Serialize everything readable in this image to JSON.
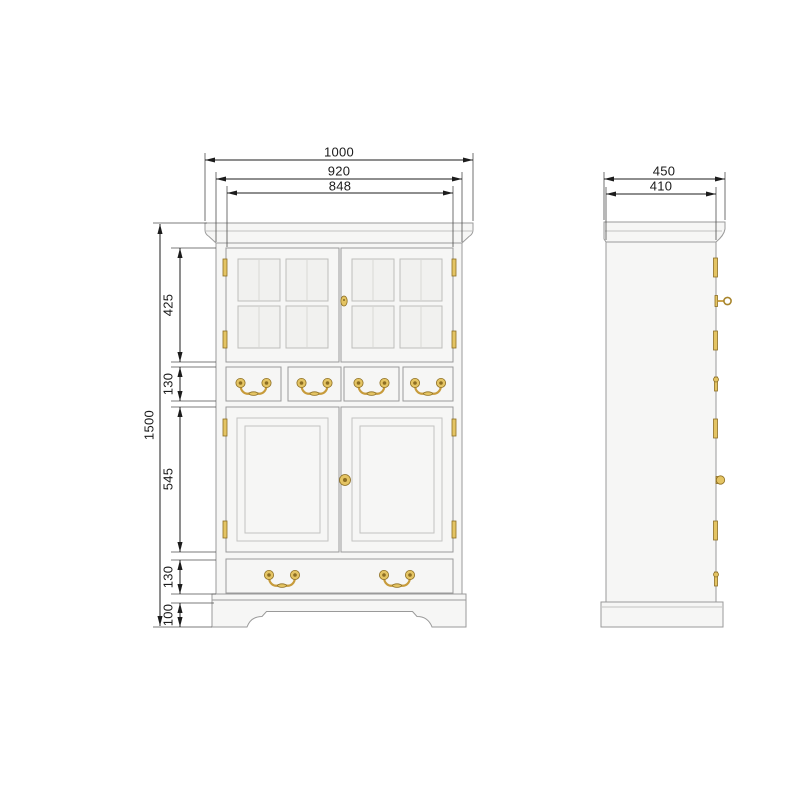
{
  "dims": {
    "front": {
      "overall_width": "1000",
      "carcass_width": "920",
      "opening_width": "848",
      "overall_height": "1500",
      "top_door_height": "425",
      "drawer_height": "130",
      "lower_door_height": "545",
      "bottom_drawer_height": "130",
      "plinth_height": "100"
    },
    "side": {
      "overall_depth": "450",
      "carcass_depth": "410"
    },
    "colors": {
      "brass": "#e4c463",
      "dimension_line": "#1c1c1c",
      "cabinet_fill": "#f6f6f5"
    }
  }
}
